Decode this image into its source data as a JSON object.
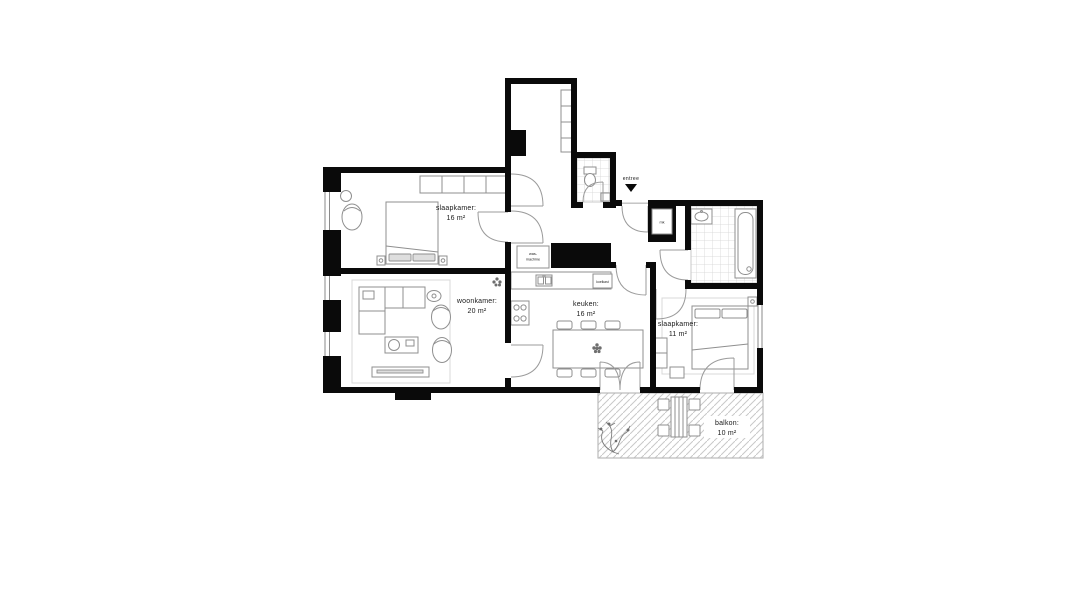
{
  "rooms": [
    {
      "id": "slaapkamer-1",
      "name": "slaapkamer:",
      "area": "16 m²"
    },
    {
      "id": "woonkamer",
      "name": "woonkamer:",
      "area": "20 m²"
    },
    {
      "id": "keuken",
      "name": "keuken:",
      "area": "16 m²"
    },
    {
      "id": "slaapkamer-2",
      "name": "slaapkamer:",
      "area": "11 m²"
    },
    {
      "id": "balkon",
      "name": "balkon:",
      "area": "10 m²"
    }
  ],
  "entrance": {
    "label": "entree"
  },
  "fixtures": {
    "washer_line1": "was-",
    "washer_line2": "machine",
    "fridge": "koelkast",
    "meter": "mk"
  },
  "colors": {
    "wall": "#0a0a0a",
    "furniture_stroke": "#8f8f8f",
    "door_stroke": "#9b9b9b",
    "tile_line": "#d4d4d4",
    "hatch_line": "#c9c9c9",
    "label_text": "#1a1a1a"
  }
}
